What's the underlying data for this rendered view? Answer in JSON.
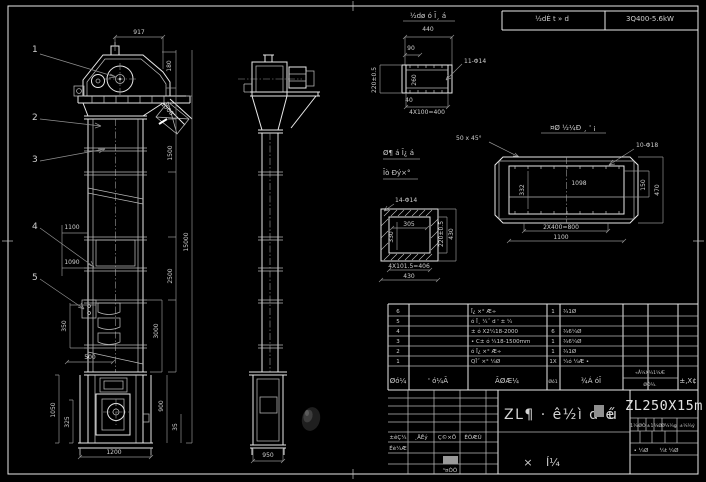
{
  "colors": {
    "background": "#000000",
    "line": "#e8e8e8",
    "dim_line": "#909090",
    "text": "#cfcfcf",
    "smudge": "#2e2e2e",
    "grey_cell": "#9a9a9a"
  },
  "header": {
    "cell_left": "½dÈ t » d",
    "cell_right": "3Q400-5.6kW"
  },
  "balloons": {
    "b1": "1",
    "b2": "2",
    "b3": "3",
    "b4": "4",
    "b5": "5"
  },
  "front_view": {
    "dim_top": "917",
    "dim_180": "180",
    "dim_1500_slant": "1500",
    "dim_1500": "1500",
    "dim_15000": "15000",
    "dim_2500": "2500",
    "dim_3000": "3000",
    "dim_1100": "1100",
    "dim_1090": "1090",
    "dim_350": "350",
    "dim_500": "500",
    "dim_1050": "1050",
    "dim_325": "325",
    "dim_1200": "1200",
    "dim_900": "900",
    "dim_35": "35"
  },
  "side_view": {
    "dim_950": "950"
  },
  "detail_top": {
    "title": "½dø ó Ī¸ á",
    "dim_440": "440",
    "dim_90": "90",
    "holes_label": "11-Φ14",
    "dim_220": "220±0.5",
    "dim_260": "260",
    "dim_40": "40",
    "dim_4x100": "4X100=400"
  },
  "detail_flange": {
    "title_line1": "Ø¶ á Ī¿ á",
    "title_line2": "Īò Ðý×°",
    "chamfer_label": "50 x 45°",
    "holes_label": "14-Φ14",
    "dim_inner_w": "305",
    "dim_inner_h": "330",
    "dim_220": "220±0.5",
    "dim_430_right": "430",
    "dim_4x101": "4X101.5=406",
    "dim_430_bottom": "430"
  },
  "detail_frame": {
    "title": "¤Ø ½¼Ð ¸ ' ¡",
    "holes_label": "10-Φ18",
    "dim_1098": "1098",
    "dim_332": "332",
    "dim_150": "150",
    "dim_470": "470",
    "dim_2x400": "2X400=800",
    "dim_1100": "1100"
  },
  "bom": {
    "rows": [
      {
        "no": "6",
        "code": "",
        "name": "Ī¿ ×° Æ÷",
        "qty": "1",
        "material": "¾1Ø",
        "note": ""
      },
      {
        "no": "5",
        "code": "",
        "name": "ó Ī¸ ¼˝ d ' ± ¼",
        "qty": "",
        "material": "",
        "note": ""
      },
      {
        "no": "4",
        "code": "",
        "name": "± ó X2¼18-2000",
        "qty": "6",
        "material": "¾6¼Ø",
        "note": ""
      },
      {
        "no": "3",
        "code": "",
        "name": "• C± ó ¼18-1500mm",
        "qty": "1",
        "material": "¾6¼Ø",
        "note": ""
      },
      {
        "no": "2",
        "code": "",
        "name": "ó Ī¿ ×° Æ÷",
        "qty": "1",
        "material": "¾1Ø",
        "note": ""
      },
      {
        "no": "1",
        "code": "",
        "name": "QĪ˝ ×° ¼Ø",
        "qty": "1X",
        "material": "¼ó ¼Æ •",
        "note": ""
      }
    ],
    "headers": {
      "no": "Øó¼",
      "code": "' ó¼Ã",
      "name": "ÃØÆ¼",
      "qty": "Øó1",
      "material": "¾Á óĪ",
      "weight_top": "«Å¼X¼1¼Æ",
      "weight_bottom": "ØÓ¼.",
      "note": "±,X¢"
    }
  },
  "title_block": {
    "main_title": "ZL¶ · ê½ì d é",
    "main_title_suffix": "ú",
    "model": "ZL250X15m",
    "stamp_left": "×",
    "stamp_right": "Í¼",
    "rev_labels": {
      "l1": "±êÇ¼",
      "l2": "¸ÄÊý",
      "l3": "Ç©×Ö",
      "l4": "ÈÕÆÚ"
    },
    "row_design": "Éè¼Æ",
    "row_process": "¹¤ÒÕ",
    "right_row": {
      "c1": "1¼",
      "c2": "ØÒ",
      "c3": "±1",
      "c4": "¼Ø",
      "c5": "Ø¼¼g",
      "c6": "±¼¼ý"
    },
    "sheets_left": "• ¼Ø",
    "sheets_right": "¼t ¼Ø"
  }
}
